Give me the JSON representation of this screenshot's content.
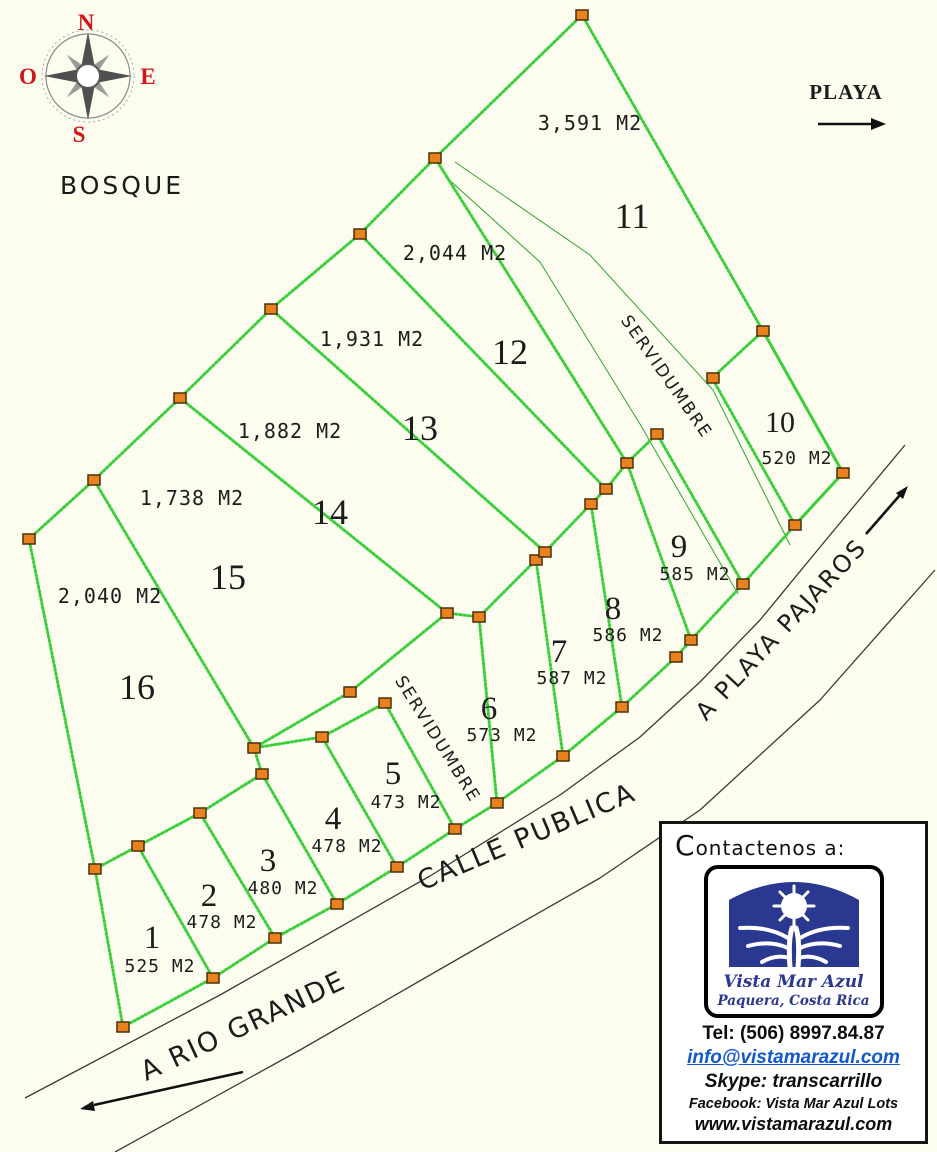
{
  "compass": {
    "n": "N",
    "s": "S",
    "e": "E",
    "o": "O"
  },
  "labels": {
    "bosque": "BOSQUE",
    "playa": "PLAYA",
    "servidumbre_upper": "SERVIDUMBRE",
    "servidumbre_lower": "SERVIDUMBRE",
    "calle_publica": "CALLE PUBLICA",
    "a_rio_grande": "A RIO GRANDE",
    "a_playa_pajaros": "A PLAYA PAJAROS"
  },
  "lots": [
    {
      "number": "1",
      "area": "525 M2"
    },
    {
      "number": "2",
      "area": "478 M2"
    },
    {
      "number": "3",
      "area": "480 M2"
    },
    {
      "number": "4",
      "area": "478 M2"
    },
    {
      "number": "5",
      "area": "473 M2"
    },
    {
      "number": "6",
      "area": "573 M2"
    },
    {
      "number": "7",
      "area": "587 M2"
    },
    {
      "number": "8",
      "area": "586 M2"
    },
    {
      "number": "9",
      "area": "585 M2"
    },
    {
      "number": "10",
      "area": "520 M2"
    },
    {
      "number": "11",
      "area": "3,591 M2"
    },
    {
      "number": "12",
      "area": "2,044 M2"
    },
    {
      "number": "13",
      "area": "1,931 M2"
    },
    {
      "number": "14",
      "area": "1,882 M2"
    },
    {
      "number": "15",
      "area": "1,738 M2"
    },
    {
      "number": "16",
      "area": "2,040 M2"
    }
  ],
  "contact": {
    "heading": "Contactenos a:",
    "logo_title": "Vista Mar Azul",
    "logo_subtitle": "Paquera, Costa Rica",
    "tel": "Tel:  (506) 8997.84.87",
    "email": "info@vistamarazul.com",
    "skype": "Skype: transcarrillo",
    "facebook": "Facebook: Vista Mar Azul Lots",
    "website": "www.vistamarazul.com"
  },
  "colors": {
    "boundary_green": "#3ccf3c",
    "marker_orange": "#e8821e",
    "logo_navy": "#2a3890",
    "email_blue": "#1158cc",
    "compass_red": "#cf1717",
    "background": "#fcfcef"
  }
}
